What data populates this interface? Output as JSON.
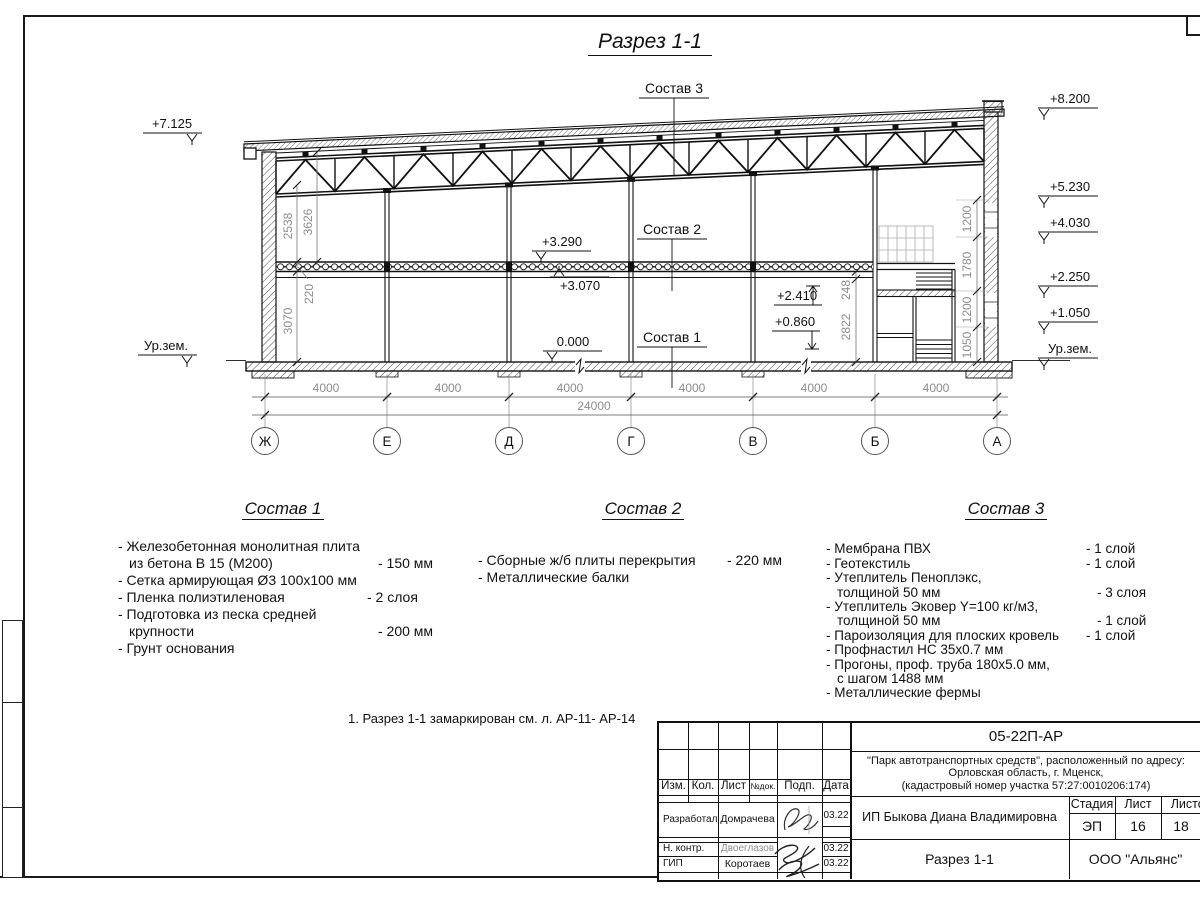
{
  "page": {
    "title": "Разрез 1-1",
    "note": "1. Разрез 1-1 замаркирован см. л. АР-11- АР-14"
  },
  "drawing": {
    "axis_labels": [
      "Ж",
      "Е",
      "Д",
      "Г",
      "В",
      "Б",
      "А"
    ],
    "span_dims": [
      "4000",
      "4000",
      "4000",
      "4000",
      "4000",
      "4000"
    ],
    "total_dim": "24000",
    "elev_left_top": "+7.125",
    "elev_left_ground": "Ур.зем.",
    "elev_right": [
      "+8.200",
      "+5.230",
      "+4.030",
      "+2.250",
      "+1.050",
      "Ур.зем."
    ],
    "elev_slab_top": "+3.290",
    "elev_slab_bot": "+3.070",
    "elev_zero": "0.000",
    "elev_stair_up": "+2.410",
    "elev_stair_dn": "+0.860",
    "dim_2538": "2538",
    "dim_3626": "3626",
    "dim_220": "220",
    "dim_3070": "3070",
    "dim_248": "248",
    "dim_2822": "2822",
    "stair_dims": [
      "1200",
      "1780",
      "1200",
      "1050"
    ]
  },
  "compositions": [
    {
      "title": "Состав 1",
      "rows": [
        {
          "t": "- Железобетонная  монолитная плита",
          "v": ""
        },
        {
          "t": "из бетона В 15 (М200)",
          "v": "- 150 мм",
          "i": true
        },
        {
          "t": "- Сетка армирующая Ø3 100х100 мм",
          "v": ""
        },
        {
          "t": "- Пленка полиэтиленовая",
          "v": "-  2 слоя"
        },
        {
          "t": "- Подготовка из песка средней",
          "v": ""
        },
        {
          "t": "крупности",
          "v": "- 200 мм",
          "i": true
        },
        {
          "t": "- Грунт основания",
          "v": ""
        }
      ]
    },
    {
      "title": "Состав 2",
      "rows": [
        {
          "t": "- Сборные ж/б плиты перекрытия",
          "v": "- 220 мм"
        },
        {
          "t": "- Металлические балки",
          "v": ""
        }
      ]
    },
    {
      "title": "Состав 3",
      "rows": [
        {
          "t": "- Мембрана ПВХ",
          "v": "- 1 слой"
        },
        {
          "t": "- Геотекстиль",
          "v": "- 1 слой"
        },
        {
          "t": "- Утеплитель Пеноплэкс,",
          "v": ""
        },
        {
          "t": "толщиной 50 мм",
          "v": "- 3 слоя",
          "i": true
        },
        {
          "t": "- Утеплитель Эковер Y=100 кг/м3,",
          "v": ""
        },
        {
          "t": "толщиной 50 мм",
          "v": "- 1 слой",
          "i": true
        },
        {
          "t": "- Пароизоляция для плоских кровель",
          "v": "- 1 слой"
        },
        {
          "t": "- Профнастил НС 35х0.7 мм",
          "v": ""
        },
        {
          "t": "- Прогоны, проф. труба 180х5.0 мм,",
          "v": ""
        },
        {
          "t": "с шагом 1488 мм",
          "v": "",
          "i": true
        },
        {
          "t": "- Металлические фермы",
          "v": ""
        }
      ]
    }
  ],
  "stamp": {
    "doc_number": "05-22П-АР",
    "project": [
      "\"Парк автотранспортных средств\",  расположенный по адресу:",
      "Орловская область, г. Мценск,",
      "(кадастровый номер участка 57:27:0010206:174)"
    ],
    "cols": [
      "Изм.",
      "Кол.",
      "Лист",
      "№док.",
      "Подп.",
      "Дата"
    ],
    "rows": [
      {
        "role": "Разработал",
        "name": "Домрачева",
        "date": "03.22"
      },
      {
        "role": "Н. контр.",
        "name": "Двоеглазов",
        "date": "03.22"
      },
      {
        "role": "ГИП",
        "name": "Коротаев",
        "date": "03.22"
      }
    ],
    "client": "ИП Быкова Диана Владимировна",
    "sheet_title": "Разрез 1-1",
    "stage_label": "Стадия",
    "sheet_label": "Лист",
    "sheets_label": "Листов",
    "stage": "ЭП",
    "sheet": "16",
    "sheets": "18",
    "company": "ООО \"Альянс\""
  }
}
